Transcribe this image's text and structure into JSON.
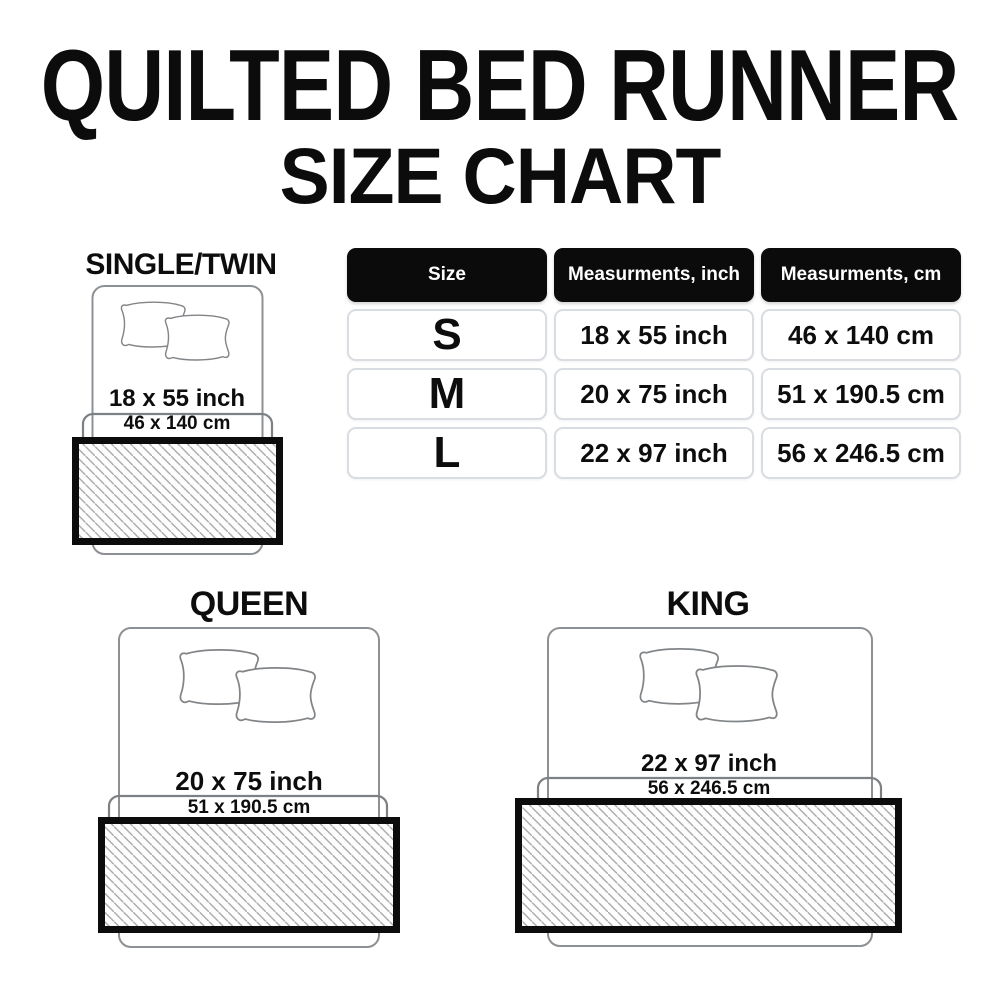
{
  "title": {
    "line1": "QUILTED BED RUNNER",
    "line2": "SIZE CHART"
  },
  "size_table": {
    "headers": [
      "Size",
      "Measurments, inch",
      "Measurments, cm"
    ],
    "rows": [
      {
        "size": "S",
        "inch": "18 x 55 inch",
        "cm": "46 x 140 cm"
      },
      {
        "size": "M",
        "inch": "20 x 75 inch",
        "cm": "51 x 190.5 cm"
      },
      {
        "size": "L",
        "inch": "22 x 97 inch",
        "cm": "56 x 246.5 cm"
      }
    ]
  },
  "diagrams": [
    {
      "label": "SINGLE/TWIN",
      "inch": "18 x 55 inch",
      "cm": "46 x 140 cm"
    },
    {
      "label": "QUEEN",
      "inch": "20 x 75 inch",
      "cm": "51 x 190.5 cm"
    },
    {
      "label": "KING",
      "inch": "22 x 97 inch",
      "cm": "56 x 246.5 cm"
    }
  ],
  "colors": {
    "background": "#ffffff",
    "text": "#0d0d0d",
    "header_bg": "#0b0b0b",
    "header_text": "#ffffff",
    "cell_border": "#d9dce0",
    "bed_outline": "#8d9094",
    "hatch_line": "#ababab",
    "runner_border": "#0c0c0c"
  }
}
